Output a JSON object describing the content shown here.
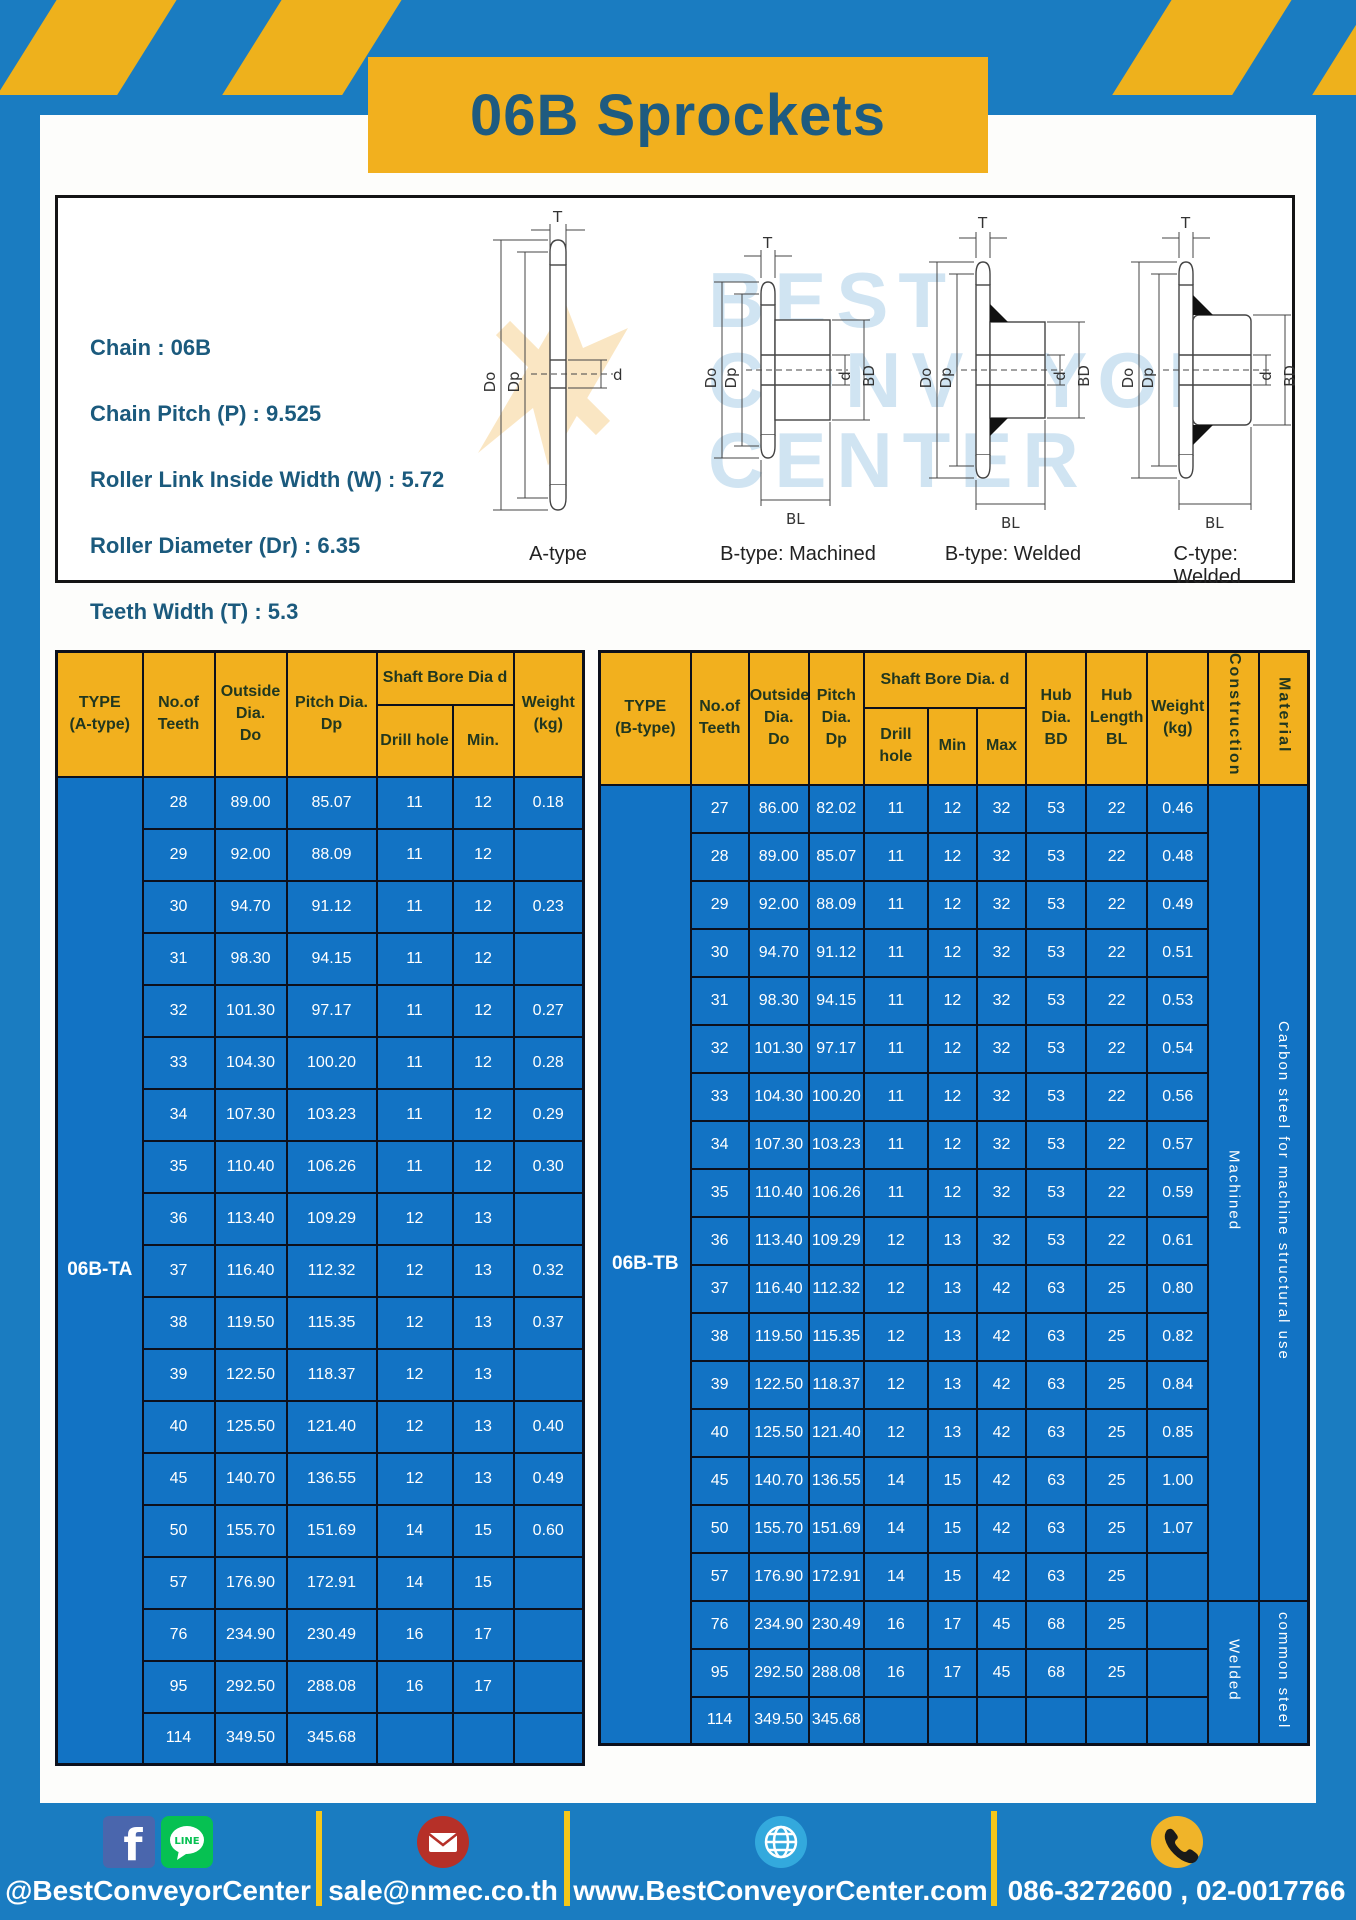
{
  "title": "06B Sprockets",
  "specs": {
    "chain": "Chain  : 06B",
    "pitch": "Chain Pitch (P)  :  9.525",
    "roller_width": "Roller Link Inside Width (W)  :  5.72",
    "roller_dia": "Roller Diameter (Dr)  : 6.35",
    "teeth_width": "Teeth Width (T)  :  5.3"
  },
  "watermark": "BEST\nCONVEYOR\nCENTER",
  "diagrams": {
    "captions": [
      "A-type",
      "B-type: Machined",
      "B-type: Welded",
      "C-type: Welded"
    ],
    "dims": {
      "t": "T",
      "do": "Do",
      "dp": "Dp",
      "d": "d",
      "bd": "BD",
      "bl": "BL"
    }
  },
  "table_a": {
    "type_label": "06B-TA",
    "headers": {
      "type": "TYPE\n(A-type)",
      "teeth": "No.of\nTeeth",
      "outside": "Outside\nDia.\nDo",
      "pitch": "Pitch Dia.\nDp",
      "shaft": "Shaft Bore Dia d",
      "drill": "Drill hole",
      "min": "Min.",
      "weight": "Weight\n(kg)"
    },
    "rows": [
      [
        "28",
        "89.00",
        "85.07",
        "11",
        "12",
        "0.18"
      ],
      [
        "29",
        "92.00",
        "88.09",
        "11",
        "12",
        ""
      ],
      [
        "30",
        "94.70",
        "91.12",
        "11",
        "12",
        "0.23"
      ],
      [
        "31",
        "98.30",
        "94.15",
        "11",
        "12",
        ""
      ],
      [
        "32",
        "101.30",
        "97.17",
        "11",
        "12",
        "0.27"
      ],
      [
        "33",
        "104.30",
        "100.20",
        "11",
        "12",
        "0.28"
      ],
      [
        "34",
        "107.30",
        "103.23",
        "11",
        "12",
        "0.29"
      ],
      [
        "35",
        "110.40",
        "106.26",
        "11",
        "12",
        "0.30"
      ],
      [
        "36",
        "113.40",
        "109.29",
        "12",
        "13",
        ""
      ],
      [
        "37",
        "116.40",
        "112.32",
        "12",
        "13",
        "0.32"
      ],
      [
        "38",
        "119.50",
        "115.35",
        "12",
        "13",
        "0.37"
      ],
      [
        "39",
        "122.50",
        "118.37",
        "12",
        "13",
        ""
      ],
      [
        "40",
        "125.50",
        "121.40",
        "12",
        "13",
        "0.40"
      ],
      [
        "45",
        "140.70",
        "136.55",
        "12",
        "13",
        "0.49"
      ],
      [
        "50",
        "155.70",
        "151.69",
        "14",
        "15",
        "0.60"
      ],
      [
        "57",
        "176.90",
        "172.91",
        "14",
        "15",
        ""
      ],
      [
        "76",
        "234.90",
        "230.49",
        "16",
        "17",
        ""
      ],
      [
        "95",
        "292.50",
        "288.08",
        "16",
        "17",
        ""
      ],
      [
        "114",
        "349.50",
        "345.68",
        "",
        "",
        ""
      ]
    ]
  },
  "table_b": {
    "type_label": "06B-TB",
    "headers": {
      "type": "TYPE\n(B-type)",
      "teeth": "No.of\nTeeth",
      "outside": "Outside\nDia.\nDo",
      "pitch": "Pitch\nDia.\nDp",
      "shaft": "Shaft Bore Dia. d",
      "drill": "Drill hole",
      "min": "Min",
      "max": "Max",
      "hub_dia": "Hub\nDia.\nBD",
      "hub_len": "Hub\nLength\nBL",
      "weight": "Weight\n(kg)",
      "construction": "Construction",
      "material": "Material"
    },
    "rows": [
      [
        "27",
        "86.00",
        "82.02",
        "11",
        "12",
        "32",
        "53",
        "22",
        "0.46"
      ],
      [
        "28",
        "89.00",
        "85.07",
        "11",
        "12",
        "32",
        "53",
        "22",
        "0.48"
      ],
      [
        "29",
        "92.00",
        "88.09",
        "11",
        "12",
        "32",
        "53",
        "22",
        "0.49"
      ],
      [
        "30",
        "94.70",
        "91.12",
        "11",
        "12",
        "32",
        "53",
        "22",
        "0.51"
      ],
      [
        "31",
        "98.30",
        "94.15",
        "11",
        "12",
        "32",
        "53",
        "22",
        "0.53"
      ],
      [
        "32",
        "101.30",
        "97.17",
        "11",
        "12",
        "32",
        "53",
        "22",
        "0.54"
      ],
      [
        "33",
        "104.30",
        "100.20",
        "11",
        "12",
        "32",
        "53",
        "22",
        "0.56"
      ],
      [
        "34",
        "107.30",
        "103.23",
        "11",
        "12",
        "32",
        "53",
        "22",
        "0.57"
      ],
      [
        "35",
        "110.40",
        "106.26",
        "11",
        "12",
        "32",
        "53",
        "22",
        "0.59"
      ],
      [
        "36",
        "113.40",
        "109.29",
        "12",
        "13",
        "32",
        "53",
        "22",
        "0.61"
      ],
      [
        "37",
        "116.40",
        "112.32",
        "12",
        "13",
        "42",
        "63",
        "25",
        "0.80"
      ],
      [
        "38",
        "119.50",
        "115.35",
        "12",
        "13",
        "42",
        "63",
        "25",
        "0.82"
      ],
      [
        "39",
        "122.50",
        "118.37",
        "12",
        "13",
        "42",
        "63",
        "25",
        "0.84"
      ],
      [
        "40",
        "125.50",
        "121.40",
        "12",
        "13",
        "42",
        "63",
        "25",
        "0.85"
      ],
      [
        "45",
        "140.70",
        "136.55",
        "14",
        "15",
        "42",
        "63",
        "25",
        "1.00"
      ],
      [
        "50",
        "155.70",
        "151.69",
        "14",
        "15",
        "42",
        "63",
        "25",
        "1.07"
      ],
      [
        "57",
        "176.90",
        "172.91",
        "14",
        "15",
        "42",
        "63",
        "25",
        ""
      ],
      [
        "76",
        "234.90",
        "230.49",
        "16",
        "17",
        "45",
        "68",
        "25",
        ""
      ],
      [
        "95",
        "292.50",
        "288.08",
        "16",
        "17",
        "45",
        "68",
        "25",
        ""
      ],
      [
        "114",
        "349.50",
        "345.68",
        "",
        "",
        "",
        "",
        "",
        ""
      ]
    ],
    "construction_groups": [
      {
        "label": "Machined",
        "rows": 17
      },
      {
        "label": "Welded",
        "rows": 3
      }
    ],
    "material_groups": [
      {
        "label": "Carbon steel for machine structural use",
        "rows": 17
      },
      {
        "label": "common steel",
        "rows": 3
      }
    ]
  },
  "footer": {
    "social_label": "@BestConveyorCenter",
    "email_label": "sale@nmec.co.th",
    "web_label": "www.BestConveyorCenter.com",
    "phone_label": "086-3272600 , 02-0017766",
    "line_text": "LINE",
    "fb_letter": "f"
  }
}
